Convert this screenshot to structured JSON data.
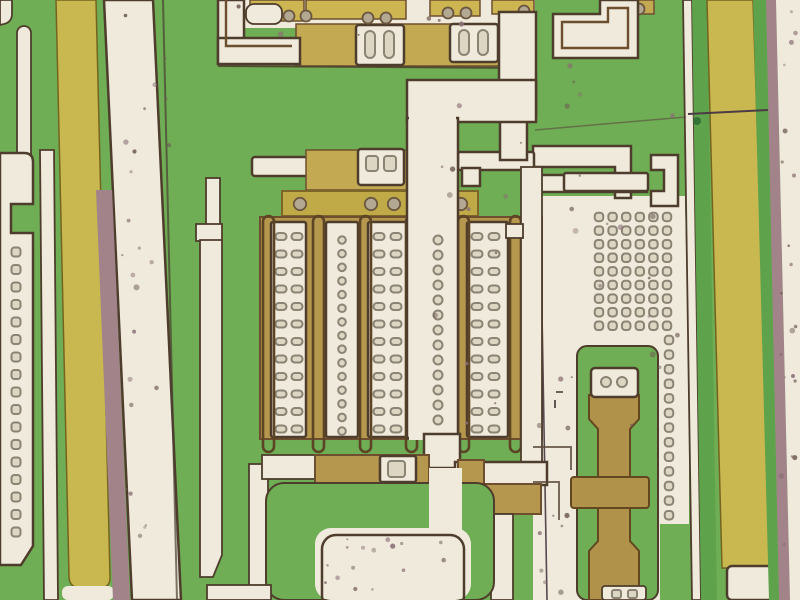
{
  "scene": {
    "width": 800,
    "height": 600
  },
  "palette": {
    "green": "#6fae54",
    "green_dim": "#5ea24b",
    "green_dark": "#4f9346",
    "cream": "#efeadb",
    "outline": "#4e3d2c",
    "brown": "#6d4f2f",
    "tan": "#b5974d",
    "tan_light": "#c3aa52",
    "tan_res": "#b0924a",
    "res_edge": "#63481f",
    "yellow": "#c9b84f",
    "yellow_deep": "#bba53d",
    "yellow_top": "#cdb552",
    "poly": "#c0aa48",
    "poly_edge": "#7c6628",
    "mauve": "#a2838a",
    "ring": "#8b8374",
    "ring_fill": "#ddd6c3",
    "contact": "#b3a992",
    "contact_edge": "#6b573f",
    "gate": "#5c4425",
    "speckle1": "#6f5b55",
    "speckle2": "#8a6f75"
  },
  "structures": {
    "left_pad_vias": {
      "x": 16,
      "y_start": 252,
      "count": 17,
      "spacing": 17.5,
      "size": 9
    },
    "array": {
      "bar_y": 222,
      "bar_h": 215,
      "bars": [
        {
          "x": 271,
          "w": 35,
          "type": "oval2",
          "cols": [
            281,
            297
          ]
        },
        {
          "x": 326,
          "w": 32,
          "type": "round1",
          "cols": [
            342
          ]
        },
        {
          "x": 368,
          "w": 39,
          "type": "oval2",
          "cols": [
            379,
            396
          ]
        },
        {
          "x": 467,
          "w": 41,
          "type": "oval2",
          "cols": [
            477,
            494
          ]
        }
      ],
      "oval_rows": {
        "start": 233,
        "count": 12,
        "spacing": 17.5,
        "w": 11,
        "h": 7
      },
      "round_rows": {
        "start": 240,
        "count": 15,
        "spacing": 13.65,
        "r": 3.8
      },
      "gates": {
        "xs": [
          263,
          313,
          360,
          406,
          458,
          510
        ],
        "y": 216,
        "h": 236,
        "w": 11
      }
    },
    "bus_vias": {
      "x": 438,
      "start": 240,
      "count": 13,
      "spacing": 15,
      "r": 4.5
    },
    "grid": {
      "cols": [
        599,
        612.6,
        626.2,
        639.8,
        653.4,
        667
      ],
      "row_start": 217,
      "row_count": 9,
      "row_spacing": 13.6,
      "size": 8.5,
      "ext_col_x": 669,
      "ext_start": 340,
      "ext_count": 13,
      "ext_spacing": 14.6
    },
    "top_contacts": {
      "r": 5.5,
      "points": [
        [
          289,
          16
        ],
        [
          306,
          16
        ],
        [
          368,
          18
        ],
        [
          386,
          18
        ],
        [
          448,
          13
        ],
        [
          466,
          13
        ],
        [
          524,
          11
        ],
        [
          621,
          9
        ],
        [
          639,
          9
        ]
      ]
    },
    "poly_bumps": {
      "r": 6.2,
      "points": [
        [
          300,
          204
        ],
        [
          371,
          204
        ],
        [
          394,
          204
        ],
        [
          430,
          204
        ],
        [
          461,
          204
        ]
      ]
    },
    "pad_rings": {
      "r": 5,
      "points": [
        [
          606,
          382
        ],
        [
          622,
          382
        ]
      ]
    },
    "speckles": {
      "seed": 13,
      "regions": [
        {
          "x": 112,
          "y": 6,
          "w": 58,
          "h": 588,
          "n": 24
        },
        {
          "x": 414,
          "y": 92,
          "w": 112,
          "h": 350,
          "n": 12
        },
        {
          "x": 548,
          "y": 205,
          "w": 130,
          "h": 225,
          "n": 14
        },
        {
          "x": 322,
          "y": 538,
          "w": 136,
          "h": 58,
          "n": 16
        },
        {
          "x": 534,
          "y": 345,
          "w": 38,
          "h": 248,
          "n": 9
        },
        {
          "x": 779,
          "y": 6,
          "w": 19,
          "h": 588,
          "n": 20
        },
        {
          "x": 228,
          "y": 2,
          "w": 290,
          "h": 58,
          "n": 6
        },
        {
          "x": 552,
          "y": 62,
          "w": 130,
          "h": 125,
          "n": 6
        }
      ]
    }
  }
}
